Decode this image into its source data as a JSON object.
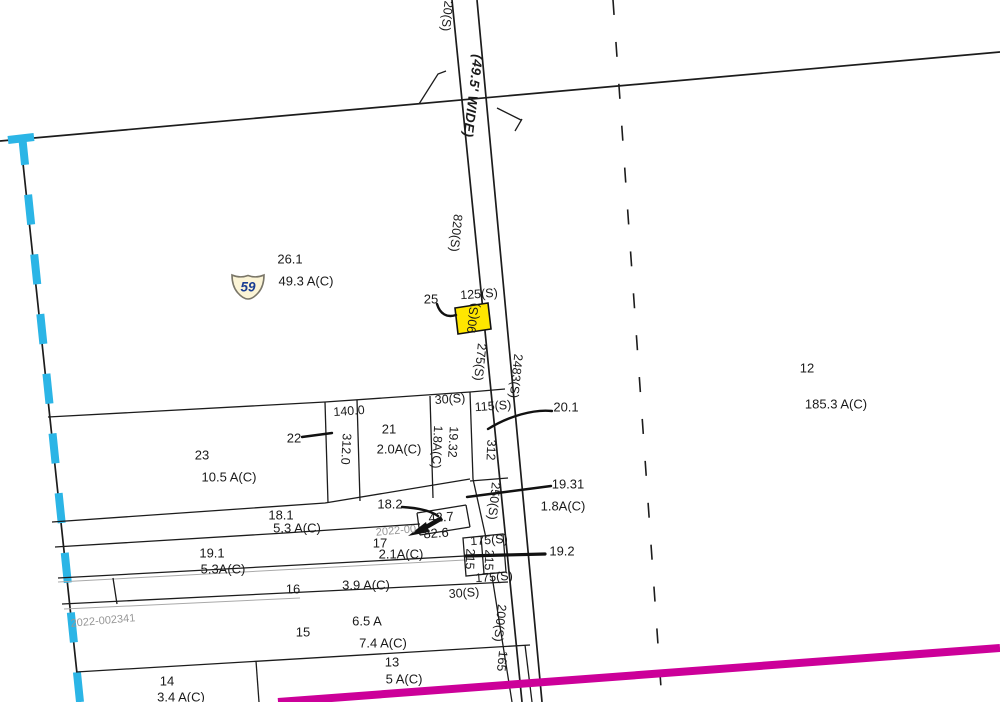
{
  "map": {
    "road_name": "(49.5' WIDE)",
    "shield": {
      "number": "59"
    },
    "highlighted_parcel_label": "90(S)",
    "colors": {
      "cyan": "#2bb5e6",
      "magenta": "#cc0099",
      "yellow": "#ffe600",
      "shield_fill": "#fbf4d6",
      "shield_stroke": "#7a7668",
      "shield_text": "#1b3e93"
    },
    "labels": [
      {
        "n": "dim-20s-top",
        "t": "20(S)",
        "x": 447,
        "y": 16,
        "r": 96,
        "c": "dim"
      },
      {
        "n": "road-name-label",
        "t": "(49.5' WIDE)",
        "x": 473,
        "y": 96,
        "r": 97,
        "c": "roadname"
      },
      {
        "n": "dim-820s",
        "t": "820(S)",
        "x": 456,
        "y": 233,
        "r": 96,
        "c": "dim"
      },
      {
        "n": "parcel-26-1-number",
        "t": "26.1",
        "x": 290,
        "y": 259,
        "r": 0,
        "c": "num"
      },
      {
        "n": "parcel-26-1-area",
        "t": "49.3 A(C)",
        "x": 306,
        "y": 281,
        "r": 0,
        "c": "num"
      },
      {
        "n": "parcel-25-number",
        "t": "25",
        "x": 431,
        "y": 299,
        "r": 0,
        "c": "num"
      },
      {
        "n": "dim-125s",
        "t": "125(S)",
        "x": 479,
        "y": 294,
        "r": -4,
        "c": "dim"
      },
      {
        "n": "dim-90s-highlighted",
        "t": "90(S)",
        "x": 473,
        "y": 318,
        "r": -84,
        "c": "dim"
      },
      {
        "n": "dim-275s",
        "t": "275(S)",
        "x": 480,
        "y": 362,
        "r": 96,
        "c": "dim"
      },
      {
        "n": "dim-2483s",
        "t": "2483(S)",
        "x": 516,
        "y": 376,
        "r": 96,
        "c": "dim"
      },
      {
        "n": "parcel-12-number",
        "t": "12",
        "x": 807,
        "y": 368,
        "r": 0,
        "c": "num"
      },
      {
        "n": "parcel-12-area",
        "t": "185.3 A(C)",
        "x": 836,
        "y": 404,
        "r": 0,
        "c": "num"
      },
      {
        "n": "dim-30s-top",
        "t": "30(S)",
        "x": 450,
        "y": 399,
        "r": -4,
        "c": "dim"
      },
      {
        "n": "dim-115s",
        "t": "115(S)",
        "x": 493,
        "y": 406,
        "r": -4,
        "c": "dim"
      },
      {
        "n": "parcel-20-1-number",
        "t": "20.1",
        "x": 566,
        "y": 407,
        "r": 0,
        "c": "num"
      },
      {
        "n": "dim-140-0",
        "t": "140.0",
        "x": 349,
        "y": 411,
        "r": -4,
        "c": "dim"
      },
      {
        "n": "parcel-22-number",
        "t": "22",
        "x": 294,
        "y": 438,
        "r": 0,
        "c": "num"
      },
      {
        "n": "parcel-21-number",
        "t": "21",
        "x": 389,
        "y": 429,
        "r": 0,
        "c": "num"
      },
      {
        "n": "parcel-21-area",
        "t": "2.0A(C)",
        "x": 399,
        "y": 449,
        "r": 0,
        "c": "num"
      },
      {
        "n": "dim-312-0",
        "t": "312.0",
        "x": 346,
        "y": 449,
        "r": 93,
        "c": "dim"
      },
      {
        "n": "dim-19-32",
        "t": "19.32",
        "x": 453,
        "y": 442,
        "r": 93,
        "c": "dim"
      },
      {
        "n": "dim-1-8ac-rotated",
        "t": "1.8A(C)",
        "x": 437,
        "y": 447,
        "r": 93,
        "c": "dim"
      },
      {
        "n": "dim-312",
        "t": "312",
        "x": 491,
        "y": 450,
        "r": 93,
        "c": "dim"
      },
      {
        "n": "parcel-23-number",
        "t": "23",
        "x": 202,
        "y": 455,
        "r": 0,
        "c": "num"
      },
      {
        "n": "parcel-23-area",
        "t": "10.5 A(C)",
        "x": 229,
        "y": 477,
        "r": 0,
        "c": "num"
      },
      {
        "n": "parcel-19-31-number",
        "t": "19.31",
        "x": 568,
        "y": 484,
        "r": 0,
        "c": "num"
      },
      {
        "n": "dim-250s",
        "t": "250(S)",
        "x": 494,
        "y": 501,
        "r": 96,
        "c": "dim"
      },
      {
        "n": "parcel-19-31-area",
        "t": "1.8A(C)",
        "x": 563,
        "y": 506,
        "r": 0,
        "c": "num"
      },
      {
        "n": "parcel-18-2-number",
        "t": "18.2",
        "x": 390,
        "y": 504,
        "r": 0,
        "c": "num"
      },
      {
        "n": "parcel-18-1-number",
        "t": "18.1",
        "x": 281,
        "y": 515,
        "r": 0,
        "c": "num"
      },
      {
        "n": "dim-42-7",
        "t": "42.7",
        "x": 441,
        "y": 517,
        "r": -4,
        "c": "num"
      },
      {
        "n": "parcel-18-1-area",
        "t": "5.3 A(C)",
        "x": 297,
        "y": 528,
        "r": 0,
        "c": "num"
      },
      {
        "n": "ref-number-upper",
        "t": "2022-00",
        "x": 396,
        "y": 531,
        "r": -5,
        "c": "ref"
      },
      {
        "n": "dim-82-6",
        "t": "82.6",
        "x": 436,
        "y": 533,
        "r": -4,
        "c": "num"
      },
      {
        "n": "dim-175s-top",
        "t": "175(S)",
        "x": 489,
        "y": 540,
        "r": -4,
        "c": "dim"
      },
      {
        "n": "parcel-17-number",
        "t": "17",
        "x": 380,
        "y": 543,
        "r": 0,
        "c": "num"
      },
      {
        "n": "parcel-19-2-number",
        "t": "19.2",
        "x": 562,
        "y": 551,
        "r": 0,
        "c": "num"
      },
      {
        "n": "parcel-19-1-number",
        "t": "19.1",
        "x": 212,
        "y": 553,
        "r": 0,
        "c": "num"
      },
      {
        "n": "parcel-17-area",
        "t": "2.1A(C)",
        "x": 401,
        "y": 554,
        "r": 0,
        "c": "num"
      },
      {
        "n": "dim-215-left",
        "t": "215",
        "x": 470,
        "y": 559,
        "r": 93,
        "c": "dim"
      },
      {
        "n": "dim-215-right",
        "t": "215",
        "x": 489,
        "y": 560,
        "r": 93,
        "c": "dim"
      },
      {
        "n": "parcel-19-1-area",
        "t": "5.3A(C)",
        "x": 223,
        "y": 569,
        "r": 0,
        "c": "num"
      },
      {
        "n": "dim-175s-bottom",
        "t": "175(S)",
        "x": 494,
        "y": 577,
        "r": -4,
        "c": "dim"
      },
      {
        "n": "parcel-16-area",
        "t": "3.9 A(C)",
        "x": 366,
        "y": 585,
        "r": 0,
        "c": "num"
      },
      {
        "n": "parcel-16-number",
        "t": "16",
        "x": 293,
        "y": 589,
        "r": 0,
        "c": "num"
      },
      {
        "n": "dim-30s-bottom",
        "t": "30(S)",
        "x": 464,
        "y": 593,
        "r": -4,
        "c": "dim"
      },
      {
        "n": "ref-number-lower",
        "t": "2022-002341",
        "x": 103,
        "y": 621,
        "r": -5,
        "c": "ref"
      },
      {
        "n": "parcel-15-area-deed",
        "t": "6.5 A",
        "x": 367,
        "y": 621,
        "r": 0,
        "c": "num"
      },
      {
        "n": "dim-200s",
        "t": "200(S)",
        "x": 500,
        "y": 623,
        "r": 96,
        "c": "dim"
      },
      {
        "n": "parcel-15-number",
        "t": "15",
        "x": 303,
        "y": 632,
        "r": 0,
        "c": "num"
      },
      {
        "n": "parcel-15-area",
        "t": "7.4 A(C)",
        "x": 383,
        "y": 643,
        "r": 0,
        "c": "num"
      },
      {
        "n": "dim-165",
        "t": "165",
        "x": 502,
        "y": 661,
        "r": 96,
        "c": "dim"
      },
      {
        "n": "parcel-13-number",
        "t": "13",
        "x": 392,
        "y": 662,
        "r": 0,
        "c": "num"
      },
      {
        "n": "parcel-13-area",
        "t": "5 A(C)",
        "x": 404,
        "y": 679,
        "r": 0,
        "c": "num"
      },
      {
        "n": "parcel-14-number",
        "t": "14",
        "x": 167,
        "y": 681,
        "r": 0,
        "c": "num"
      },
      {
        "n": "parcel-14-area",
        "t": "3.4 A(C)",
        "x": 181,
        "y": 697,
        "r": 0,
        "c": "num"
      }
    ]
  }
}
